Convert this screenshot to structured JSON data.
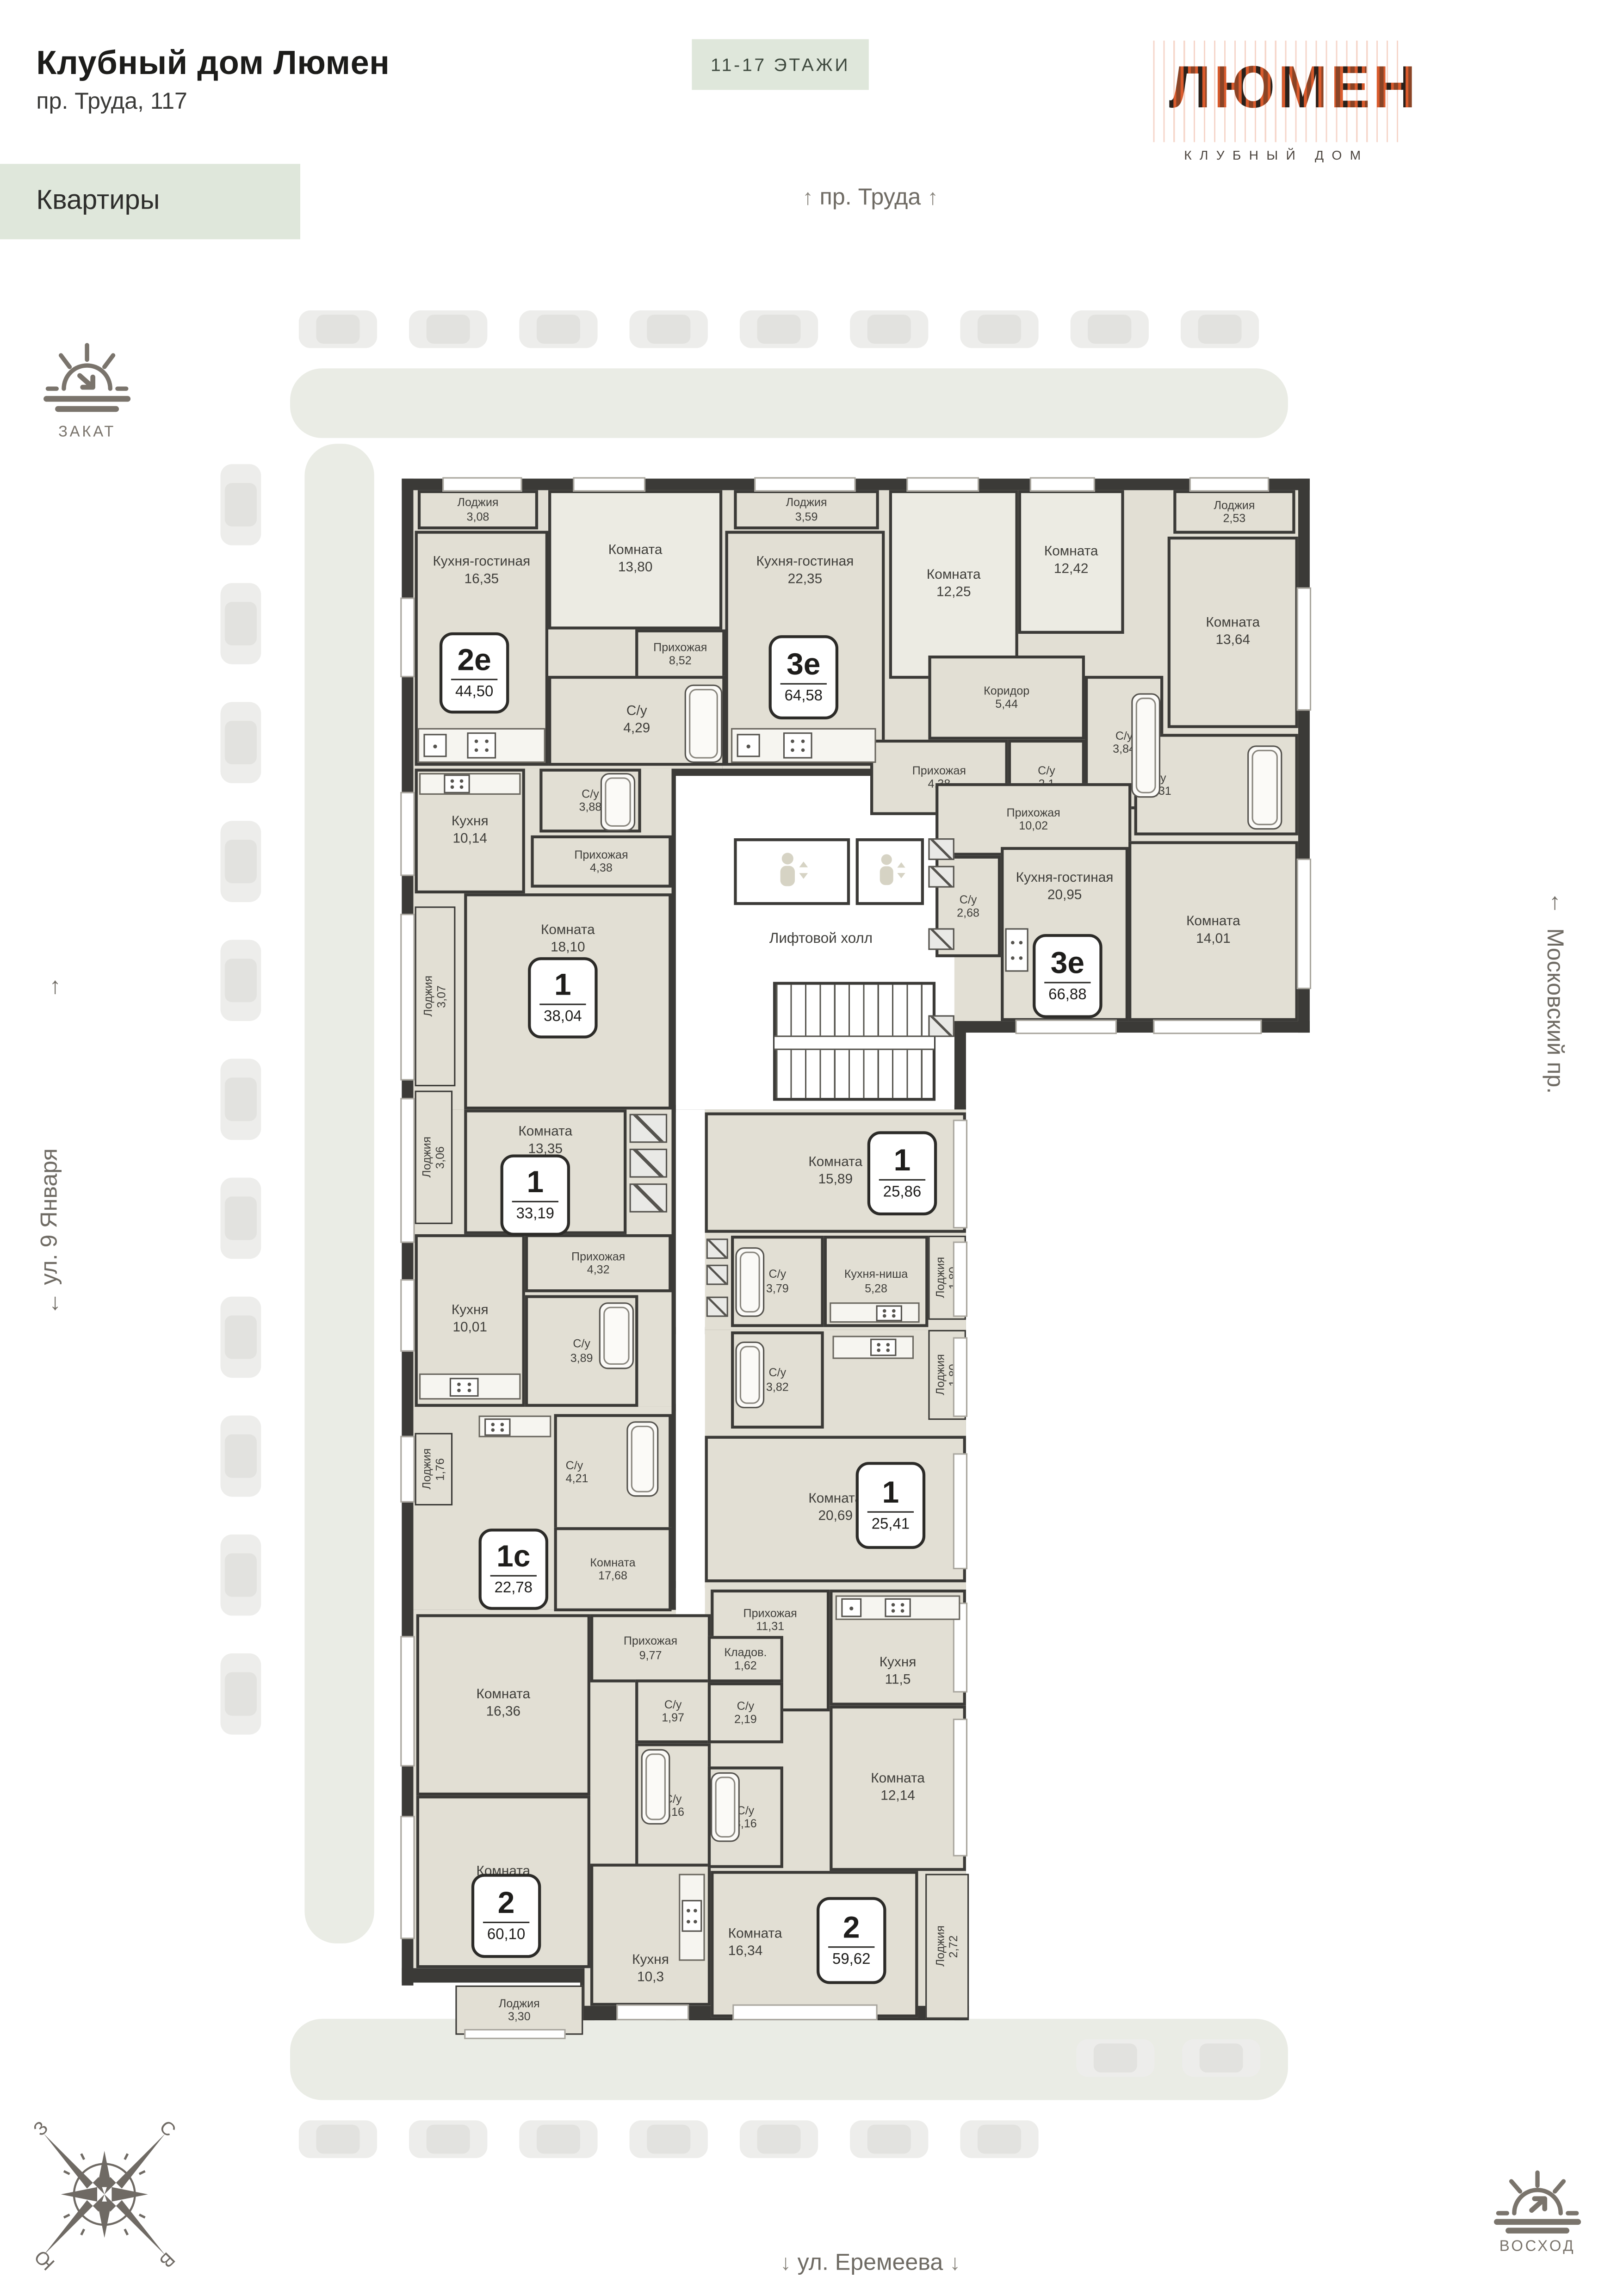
{
  "header": {
    "title": "Клубный дом Люмен",
    "address": "пр. Труда, 117",
    "floors_badge": "11-17 ЭТАЖИ",
    "section_label": "Квартиры",
    "logo_text": "ЛЮМЕН",
    "logo_subtitle": "КЛУБНЫЙ ДОМ"
  },
  "streets": {
    "top": "пр. Труда",
    "left": "ул. 9 Января",
    "right": "Московский пр.",
    "bottom": "ул. Еремеева",
    "arrow_up": "↑",
    "arrow_down": "↓"
  },
  "sun": {
    "sunset": "ЗАКАТ",
    "sunrise": "ВОСХОД"
  },
  "compass": {
    "n": "С",
    "e": "В",
    "s": "Ю",
    "w": "З"
  },
  "common": {
    "elevator_hall": "Лифтовой холл"
  },
  "colors": {
    "accent_green": "#dfe7db",
    "wall": "#3b3a37",
    "room_fill": "#e2dfd4",
    "logo_orange": "#d95b2d"
  },
  "apartments": [
    {
      "id": "2e-44-50",
      "type": "2е",
      "area": "44,50",
      "rooms": [
        {
          "name": "Лоджия",
          "area": "3,08"
        },
        {
          "name": "Кухня-гостиная",
          "area": "16,35"
        },
        {
          "name": "Комната",
          "area": "13,80"
        },
        {
          "name": "Прихожая",
          "area": "8,52"
        },
        {
          "name": "С/у",
          "area": "4,29"
        }
      ]
    },
    {
      "id": "3e-64-58",
      "type": "3е",
      "area": "64,58",
      "rooms": [
        {
          "name": "Лоджия",
          "area": "3,59"
        },
        {
          "name": "Кухня-гостиная",
          "area": "22,35"
        },
        {
          "name": "Комната",
          "area": "12,25"
        },
        {
          "name": "Комната",
          "area": "12,42"
        },
        {
          "name": "Коридор",
          "area": "5,44"
        },
        {
          "name": "С/у",
          "area": "3,84"
        },
        {
          "name": "С/у",
          "area": "2,1"
        },
        {
          "name": "Прихожая",
          "area": "4,38"
        }
      ]
    },
    {
      "id": "3e-66-88",
      "type": "3е",
      "area": "66,88",
      "rooms": [
        {
          "name": "Лоджия",
          "area": "2,53"
        },
        {
          "name": "Комната",
          "area": "13,64"
        },
        {
          "name": "С/у",
          "area": "4,31"
        },
        {
          "name": "Прихожая",
          "area": "10,02"
        },
        {
          "name": "С/у",
          "area": "2,68"
        },
        {
          "name": "Кухня-гостиная",
          "area": "20,95"
        },
        {
          "name": "Комната",
          "area": "14,01"
        }
      ]
    },
    {
      "id": "1-38-04",
      "type": "1",
      "area": "38,04",
      "rooms": [
        {
          "name": "Кухня",
          "area": "10,14"
        },
        {
          "name": "С/у",
          "area": "3,88"
        },
        {
          "name": "Прихожая",
          "area": "4,38"
        },
        {
          "name": "Комната",
          "area": "18,10"
        },
        {
          "name": "Лоджия",
          "area": "3,07"
        }
      ]
    },
    {
      "id": "1-33-19",
      "type": "1",
      "area": "33,19",
      "rooms": [
        {
          "name": "Комната",
          "area": "13,35"
        },
        {
          "name": "Лоджия",
          "area": "3,06"
        },
        {
          "name": "Прихожая",
          "area": "4,32"
        },
        {
          "name": "Кухня",
          "area": "10,01"
        },
        {
          "name": "С/у",
          "area": "3,89"
        }
      ]
    },
    {
      "id": "1-25-86",
      "type": "1",
      "area": "25,86",
      "rooms": [
        {
          "name": "Комната",
          "area": "15,89"
        },
        {
          "name": "С/у",
          "area": "3,79"
        },
        {
          "name": "Кухня-ниша",
          "area": "5,28"
        },
        {
          "name": "Лоджия",
          "area": "1,80"
        }
      ]
    },
    {
      "id": "1-25-41",
      "type": "1",
      "area": "25,41",
      "rooms": [
        {
          "name": "С/у",
          "area": "3,82"
        },
        {
          "name": "Лоджия",
          "area": "1,80"
        },
        {
          "name": "Комната",
          "area": "20,69"
        }
      ]
    },
    {
      "id": "1s-22-78",
      "type": "1с",
      "area": "22,78",
      "rooms": [
        {
          "name": "Лоджия",
          "area": "1,76"
        },
        {
          "name": "С/у",
          "area": "4,21"
        },
        {
          "name": "Комната",
          "area": "17,68"
        }
      ]
    },
    {
      "id": "2-60-10",
      "type": "2",
      "area": "60,10",
      "rooms": [
        {
          "name": "Комната",
          "area": "16,36"
        },
        {
          "name": "Прихожая",
          "area": "9,77"
        },
        {
          "name": "С/у",
          "area": "1,97"
        },
        {
          "name": "С/у",
          "area": "3,16"
        },
        {
          "name": "Комната",
          "area": "16,89"
        },
        {
          "name": "Кухня",
          "area": "10,3"
        },
        {
          "name": "Лоджия",
          "area": "3,30"
        }
      ]
    },
    {
      "id": "2-59-62",
      "type": "2",
      "area": "59,62",
      "rooms": [
        {
          "name": "Прихожая",
          "area": "11,31"
        },
        {
          "name": "Кладов.",
          "area": "1,62"
        },
        {
          "name": "С/у",
          "area": "2,19"
        },
        {
          "name": "Кухня",
          "area": "11,5"
        },
        {
          "name": "Комната",
          "area": "12,14"
        },
        {
          "name": "С/у",
          "area": "3,16"
        },
        {
          "name": "Комната",
          "area": "16,34"
        },
        {
          "name": "Лоджия",
          "area": "2,72"
        }
      ]
    }
  ]
}
